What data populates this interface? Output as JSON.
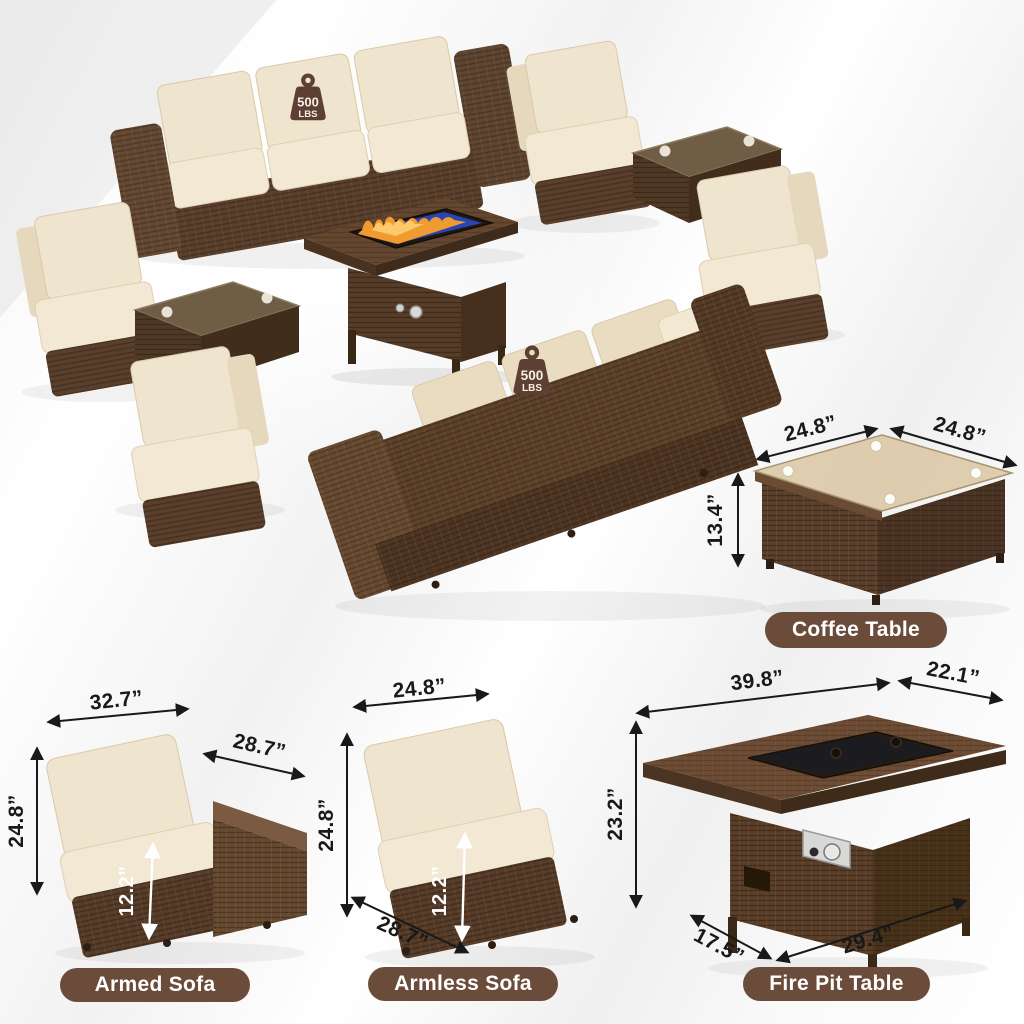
{
  "weight_badge": {
    "value": "500",
    "unit": "LBS"
  },
  "items": {
    "coffee_table": {
      "label": "Coffee Table",
      "dimensions": {
        "top_width": "24.8”",
        "top_depth": "24.8”",
        "height": "13.4”"
      }
    },
    "armed_sofa": {
      "label": "Armed Sofa",
      "dimensions": {
        "width": "32.7”",
        "depth": "28.7”",
        "height": "24.8”",
        "base_height": "12.2”"
      }
    },
    "armless_sofa": {
      "label": "Armless Sofa",
      "dimensions": {
        "width": "24.8”",
        "height": "24.8”",
        "base_height": "12.2”",
        "depth": "28.7”"
      }
    },
    "fire_pit_table": {
      "label": "Fire Pit Table",
      "dimensions": {
        "top_width": "39.8”",
        "top_depth": "22.1”",
        "height": "23.2”",
        "base_depth": "17.5”",
        "base_width": "29.4”"
      }
    }
  },
  "colors": {
    "wicker_brown": "#5a3f2b",
    "wicker_dark": "#46301d",
    "wicker_light": "#7a5a40",
    "cushion_beige": "#f0e5cf",
    "label_pill_brown": "#6b4c3a",
    "label_text": "#ffffff",
    "dimension_text": "#191919",
    "weight_icon_brown": "#5d4033",
    "fire_glass_blue": "#2945b5",
    "flame_orange": "#f59a2e",
    "background_gray": "#ececec"
  }
}
